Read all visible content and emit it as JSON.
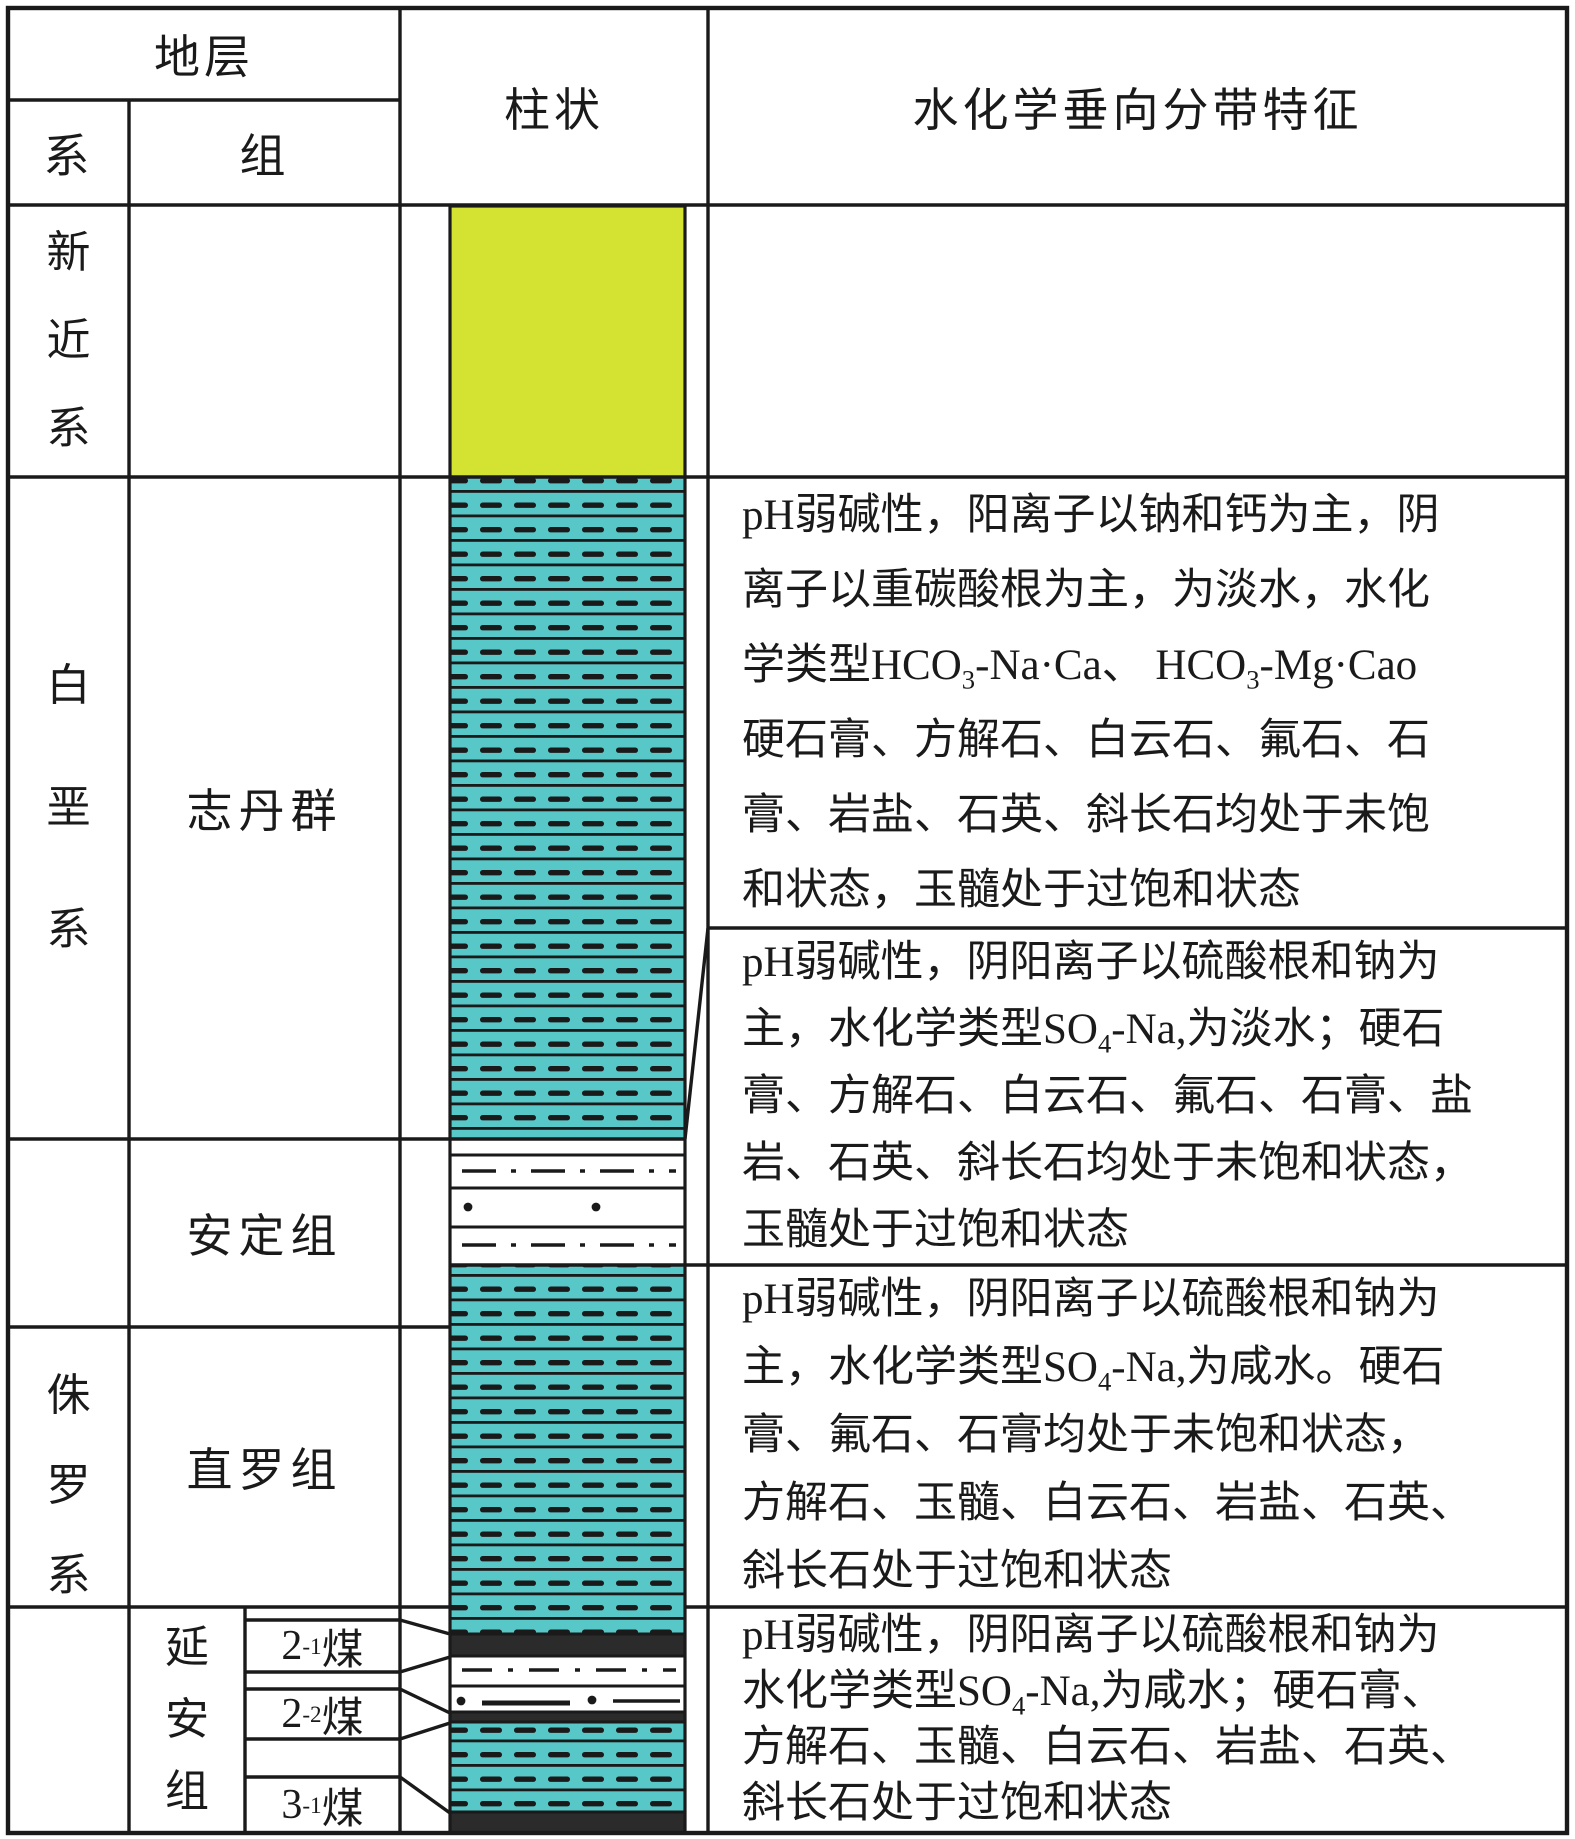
{
  "header": {
    "stratum": "地层",
    "system": "系",
    "formation": "组",
    "column": "柱状",
    "hydrochem": "水化学垂向分带特征"
  },
  "systems": {
    "neogene": "新近系",
    "cretaceous": "白垩系",
    "jurassic": "侏罗系"
  },
  "formations": {
    "zhidan_group": "志丹群",
    "anding": "安定组",
    "zhiluo": "直罗组",
    "yanan": "延安组"
  },
  "coal_seams": {
    "seam_2_1": "2^-1^煤",
    "seam_2_2": "2^-2^煤",
    "seam_3_1": "3^-1^煤"
  },
  "descriptions": {
    "block1": {
      "lines": [
        "pH弱碱性，阳离子以钠和钙为主，阴",
        "离子以重碳酸根为主，为淡水，水化",
        "学类型HCO~3~-Na·Ca、 HCO~3~-Mg·Cao",
        "硬石膏、方解石、白云石、氟石、石",
        "膏、岩盐、石英、斜长石均处于未饱",
        "和状态，玉髓处于过饱和状态"
      ]
    },
    "block2": {
      "lines": [
        "pH弱碱性，阴阳离子以硫酸根和钠为",
        "主，水化学类型SO~4~-Na,为淡水；硬石",
        "膏、方解石、白云石、氟石、石膏、盐",
        "岩、石英、斜长石均处于未饱和状态，",
        "玉髓处于过饱和状态"
      ]
    },
    "block3": {
      "lines": [
        "pH弱碱性，阴阳离子以硫酸根和钠为",
        "主，水化学类型SO~4~-Na,为咸水。硬石",
        "膏、氟石、石膏均处于未饱和状态，",
        "方解石、玉髓、白云石、岩盐、石英、",
        "斜长石处于过饱和状态"
      ]
    },
    "block4": {
      "lines": [
        "pH弱碱性，阴阳离子以硫酸根和钠为",
        "水化学类型SO~4~-Na,为咸水；硬石膏、",
        "方解石、玉髓、白云石、岩盐、石英、",
        "斜长石处于过饱和状态"
      ]
    }
  },
  "colors": {
    "neogene_fill": "#d4e332",
    "aquifer_fill": "#58c7c8",
    "coal_fill": "#2b2b2b",
    "line_color": "#1a1a1a"
  }
}
